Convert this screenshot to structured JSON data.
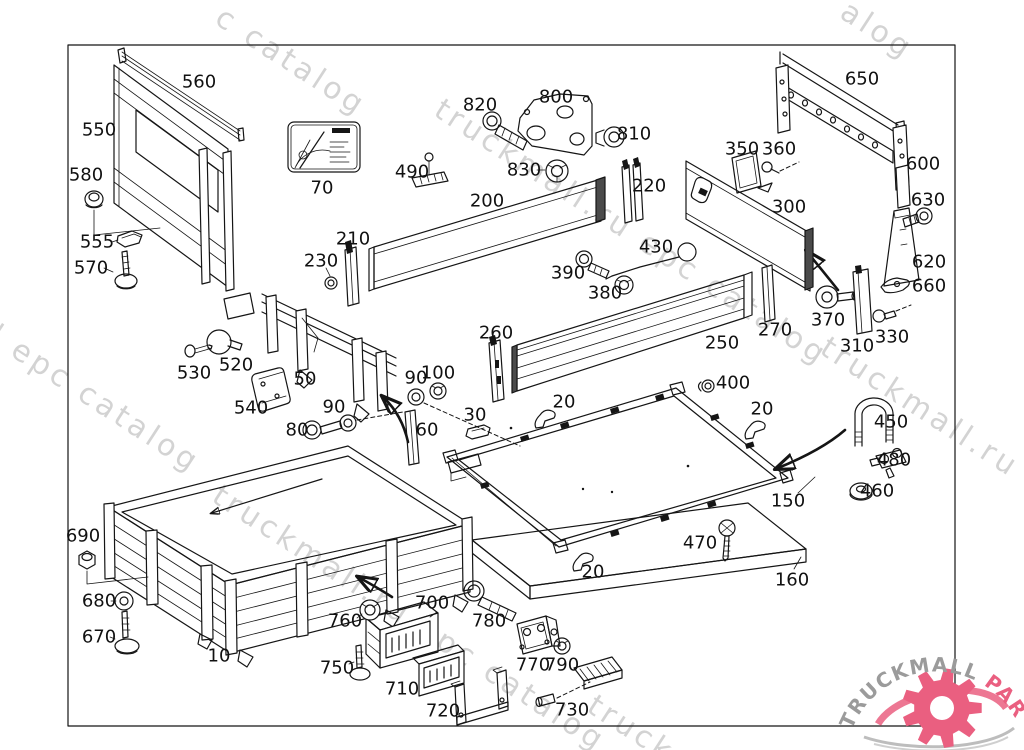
{
  "page": {
    "background": "#ffffff",
    "border_color": "#000000"
  },
  "watermark": {
    "text": "truckmall.ru epc catalog",
    "color": "#c9c9c9",
    "angle_deg": 33,
    "fragments": [
      {
        "text": "c catalog",
        "x": 228,
        "y": 0
      },
      {
        "text": "alog",
        "x": 853,
        "y": -6
      },
      {
        "text": "truckmall.ru epc catalog",
        "x": 447,
        "y": 92
      },
      {
        "text": "truckmall.ru e",
        "x": 833,
        "y": 330
      },
      {
        "text": "l epc catalog",
        "x": 2,
        "y": 318
      },
      {
        "text": "truckmall.ru epc catalog",
        "x": 225,
        "y": 478
      },
      {
        "text": "truck",
        "x": 600,
        "y": 688
      }
    ]
  },
  "logo": {
    "text_gray": "TRUCKMALL",
    "text_pink": "PARTS",
    "gray_color": "#9b9b9b",
    "pink_color": "#ea5f80"
  },
  "parts": [
    {
      "label": "560",
      "x": 199,
      "y": 82
    },
    {
      "label": "550",
      "x": 99,
      "y": 130
    },
    {
      "label": "580",
      "x": 86,
      "y": 175
    },
    {
      "label": "555",
      "x": 97,
      "y": 242
    },
    {
      "label": "570",
      "x": 91,
      "y": 268
    },
    {
      "label": "70",
      "x": 322,
      "y": 188
    },
    {
      "label": "820",
      "x": 480,
      "y": 105
    },
    {
      "label": "800",
      "x": 556,
      "y": 97
    },
    {
      "label": "810",
      "x": 634,
      "y": 134
    },
    {
      "label": "830",
      "x": 524,
      "y": 170
    },
    {
      "label": "490",
      "x": 412,
      "y": 172
    },
    {
      "label": "200",
      "x": 487,
      "y": 201
    },
    {
      "label": "220",
      "x": 649,
      "y": 186
    },
    {
      "label": "210",
      "x": 353,
      "y": 239
    },
    {
      "label": "230",
      "x": 321,
      "y": 261
    },
    {
      "label": "650",
      "x": 862,
      "y": 79
    },
    {
      "label": "600",
      "x": 923,
      "y": 164
    },
    {
      "label": "630",
      "x": 928,
      "y": 200
    },
    {
      "label": "350",
      "x": 742,
      "y": 149
    },
    {
      "label": "360",
      "x": 779,
      "y": 149
    },
    {
      "label": "300",
      "x": 789,
      "y": 207
    },
    {
      "label": "620",
      "x": 929,
      "y": 262
    },
    {
      "label": "660",
      "x": 929,
      "y": 286
    },
    {
      "label": "430",
      "x": 656,
      "y": 247
    },
    {
      "label": "390",
      "x": 568,
      "y": 273
    },
    {
      "label": "380",
      "x": 605,
      "y": 293
    },
    {
      "label": "270",
      "x": 775,
      "y": 330
    },
    {
      "label": "250",
      "x": 722,
      "y": 343
    },
    {
      "label": "260",
      "x": 496,
      "y": 333
    },
    {
      "label": "370",
      "x": 828,
      "y": 320
    },
    {
      "label": "310",
      "x": 857,
      "y": 346
    },
    {
      "label": "330",
      "x": 892,
      "y": 337
    },
    {
      "label": "530",
      "x": 194,
      "y": 373
    },
    {
      "label": "520",
      "x": 236,
      "y": 365
    },
    {
      "label": "540",
      "x": 251,
      "y": 408
    },
    {
      "label": "50",
      "x": 305,
      "y": 379
    },
    {
      "label": "90",
      "x": 416,
      "y": 378
    },
    {
      "label": "100",
      "x": 438,
      "y": 373
    },
    {
      "label": "90",
      "x": 334,
      "y": 407
    },
    {
      "label": "80",
      "x": 297,
      "y": 430
    },
    {
      "label": "60",
      "x": 427,
      "y": 430
    },
    {
      "label": "30",
      "x": 475,
      "y": 415
    },
    {
      "label": "20",
      "x": 564,
      "y": 402
    },
    {
      "label": "400",
      "x": 733,
      "y": 383
    },
    {
      "label": "20",
      "x": 762,
      "y": 409
    },
    {
      "label": "450",
      "x": 891,
      "y": 422
    },
    {
      "label": "480",
      "x": 894,
      "y": 460
    },
    {
      "label": "460",
      "x": 877,
      "y": 491
    },
    {
      "label": "150",
      "x": 788,
      "y": 501
    },
    {
      "label": "470",
      "x": 700,
      "y": 543
    },
    {
      "label": "160",
      "x": 792,
      "y": 580
    },
    {
      "label": "20",
      "x": 593,
      "y": 572
    },
    {
      "label": "690",
      "x": 83,
      "y": 536
    },
    {
      "label": "680",
      "x": 99,
      "y": 601
    },
    {
      "label": "670",
      "x": 99,
      "y": 637
    },
    {
      "label": "10",
      "x": 219,
      "y": 656
    },
    {
      "label": "700",
      "x": 432,
      "y": 603
    },
    {
      "label": "760",
      "x": 345,
      "y": 621
    },
    {
      "label": "750",
      "x": 337,
      "y": 668
    },
    {
      "label": "710",
      "x": 402,
      "y": 689
    },
    {
      "label": "720",
      "x": 443,
      "y": 711
    },
    {
      "label": "780",
      "x": 489,
      "y": 621
    },
    {
      "label": "770",
      "x": 533,
      "y": 665
    },
    {
      "label": "790",
      "x": 562,
      "y": 665
    },
    {
      "label": "730",
      "x": 572,
      "y": 710
    }
  ]
}
